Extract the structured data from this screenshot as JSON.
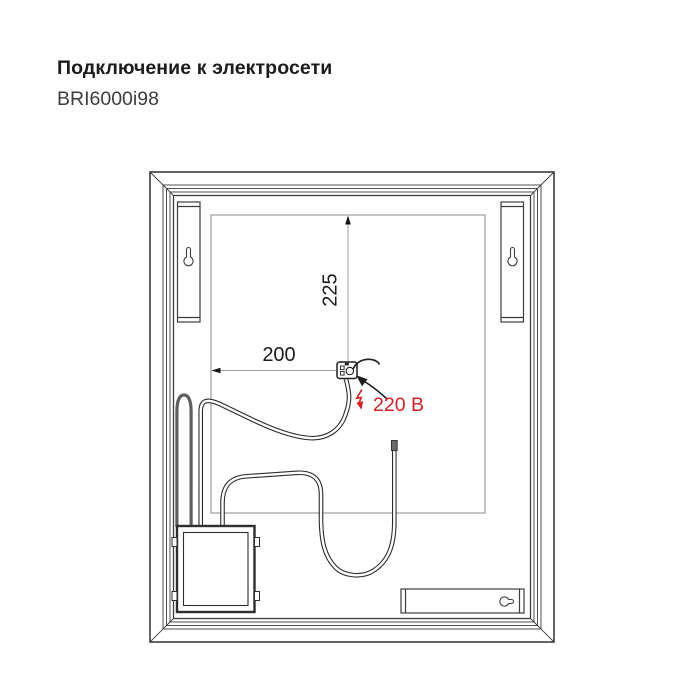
{
  "header": {
    "title": "Подключение к электросети",
    "model": "BRI6000i98"
  },
  "diagram": {
    "dim_vertical": "225",
    "dim_horizontal": "200",
    "voltage": "220 В",
    "colors": {
      "accent_red": "#d61f26",
      "frame_line": "#3e3e3e",
      "dim_line": "#9d9d9d",
      "cable_outline": "#2c2c2c",
      "mains_cable_gray": "#5e5e5e"
    }
  }
}
